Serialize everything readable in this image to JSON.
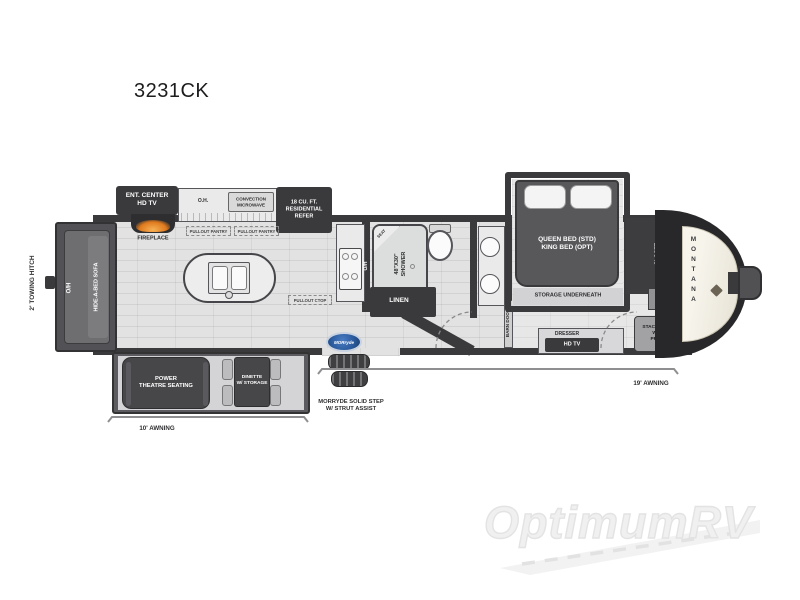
{
  "title": "3231CK",
  "watermark": "OptimumRV",
  "logos": {
    "brand": "MONTANA",
    "step": "MORryde"
  },
  "exterior": {
    "towing_hitch": "2' TOWING HITCH",
    "awning_left": "10' AWNING",
    "awning_right": "19' AWNING",
    "step_label": "MORRYDE SOLID STEP\nW/ STRUT ASSIST"
  },
  "living": {
    "sofa_oh": "O/H",
    "sofa": "HIDE-A-BED SOFA",
    "ent_center": "ENT. CENTER\nHD TV",
    "fireplace": "FIREPLACE",
    "theatre": "POWER\nTHEATRE SEATING",
    "dinette": "DINETTE\nW/ STORAGE"
  },
  "kitchen": {
    "overhead": "O.H.",
    "microwave": "CONVECTION\nMICROWAVE",
    "fridge": "18 CU. FT.\nRESIDENTIAL\nREFER",
    "pantry_1": "PULLOUT PANTRY",
    "pantry_2": "PULLOUT PANTRY",
    "pullout_ctop": "PULLOUT CTOP",
    "range_oh": "O/H"
  },
  "bath": {
    "shower": "48\"X30\"\nSHOWER",
    "seat": "SEAT",
    "linen": "LINEN",
    "barn_door": "BARN DOOR"
  },
  "bedroom": {
    "bed": "QUEEN BED (STD)\nKING BED (OPT)",
    "storage": "STORAGE UNDERNEATH",
    "closet": "CLOSET",
    "hamper": "CLOTHING\nHAMPER",
    "wd_prep": "STACKABLE\nW/D\nPREP",
    "dresser": "DRESSER",
    "tv": "HD TV"
  },
  "colors": {
    "flame": "#e08220",
    "morryde_blue": "#2c5c9e",
    "wall": "#3a3a3c",
    "watermark": "#ededed"
  }
}
